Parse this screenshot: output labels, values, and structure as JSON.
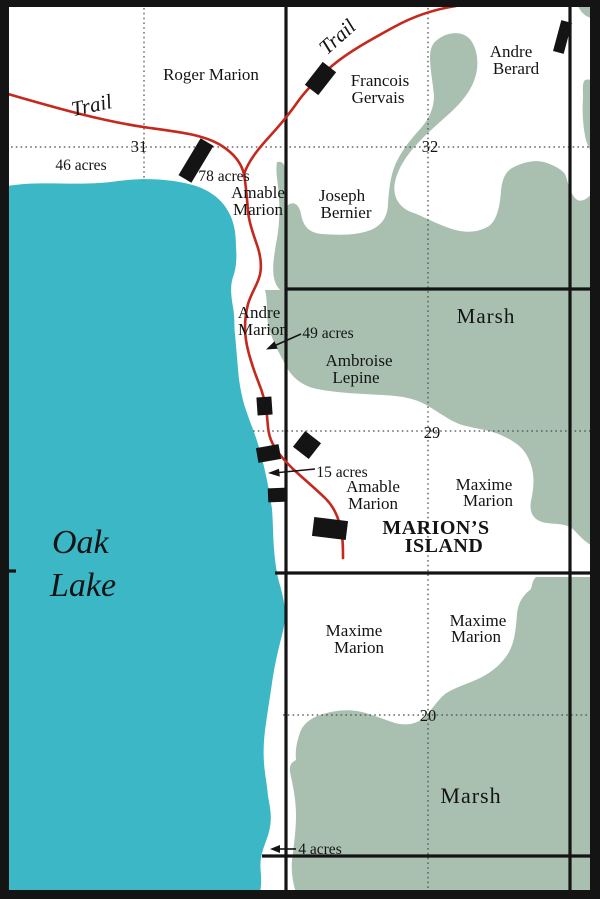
{
  "colors": {
    "lake": "#3bb7c6",
    "marsh": "#a9c0b1",
    "trail": "#c5281c",
    "ink": "#141414"
  },
  "lake": {
    "l1": "Oak",
    "l2": "Lake"
  },
  "trails": {
    "west_label": "Trail",
    "north_label": "Trail"
  },
  "sections": {
    "s31": "31",
    "s32": "32",
    "s29": "29",
    "s20": "20"
  },
  "acreages": {
    "a46": "46 acres",
    "a78": "78 acres",
    "a49": "49 acres",
    "a15": "15 acres",
    "a4": "4 acres"
  },
  "marsh_labels": {
    "north": "Marsh",
    "south": "Marsh"
  },
  "island": {
    "l1": "MARION’S",
    "l2": "ISLAND"
  },
  "owners": {
    "roger_marion": {
      "l1": "Roger Marion"
    },
    "francois_gervais": {
      "l1": "Francois",
      "l2": "Gervais"
    },
    "andre_berard": {
      "l1": "Andre",
      "l2": "Berard"
    },
    "joseph_bernier": {
      "l1": "Joseph",
      "l2": "Bernier"
    },
    "amable_marion_north": {
      "l1": "Amable",
      "l2": "Marion"
    },
    "andre_marion": {
      "l1": "Andre",
      "l2": "Marion"
    },
    "ambroise_lepine": {
      "l1": "Ambroise",
      "l2": "Lepine"
    },
    "amable_marion_island": {
      "l1": "Amable",
      "l2": "Marion"
    },
    "maxime_marion_east": {
      "l1": "Maxime",
      "l2": "Marion"
    },
    "maxime_marion_sw": {
      "l1": "Maxime",
      "l2": "Marion"
    },
    "maxime_marion_se": {
      "l1": "Maxime",
      "l2": "Marion"
    }
  }
}
